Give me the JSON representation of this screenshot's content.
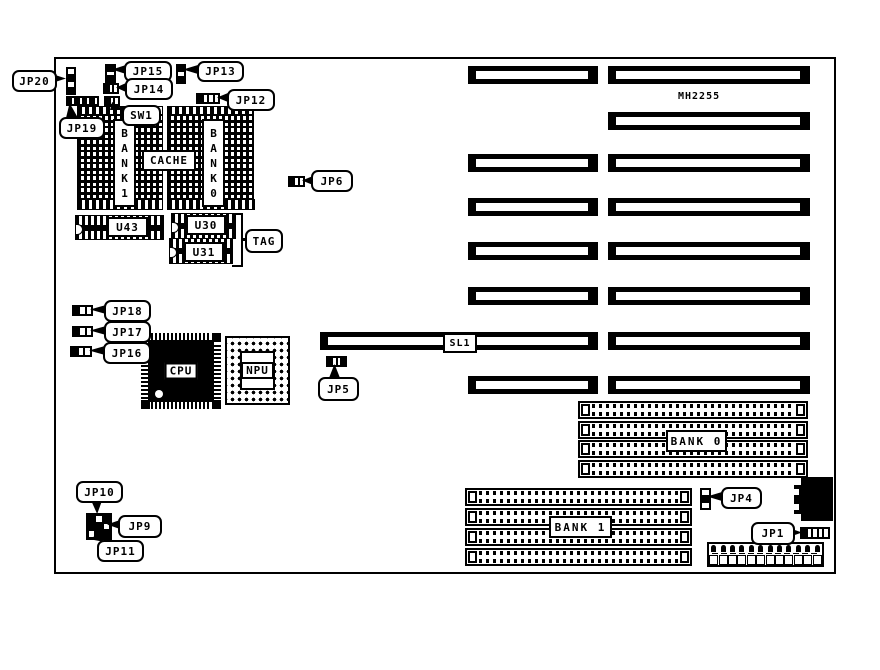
{
  "colors": {
    "ink": "#000000",
    "paper": "#ffffff"
  },
  "board_title": "MH2255",
  "callouts": {
    "jp20": "JP20",
    "jp19": "JP19",
    "jp15": "JP15",
    "jp14": "JP14",
    "jp13": "JP13",
    "jp12": "JP12",
    "sw1": "SW1",
    "jp6": "JP6",
    "jp18": "JP18",
    "jp17": "JP17",
    "jp16": "JP16",
    "jp5": "JP5",
    "jp10": "JP10",
    "jp9": "JP9",
    "jp11": "JP11",
    "jp4": "JP4",
    "jp1": "JP1",
    "tag": "TAG"
  },
  "chips": {
    "cpu": "CPU",
    "npu": "NPU",
    "cache": "CACHE",
    "u43": "U43",
    "u30": "U30",
    "u31": "U31",
    "bank1_vertical": "B\nA\nN\nK\n1",
    "bank0_vertical": "B\nA\nN\nK\n0"
  },
  "memory": {
    "bank0": "BANK 0",
    "bank1": "BANK 1"
  },
  "slots": {
    "sl1": "SL1"
  }
}
